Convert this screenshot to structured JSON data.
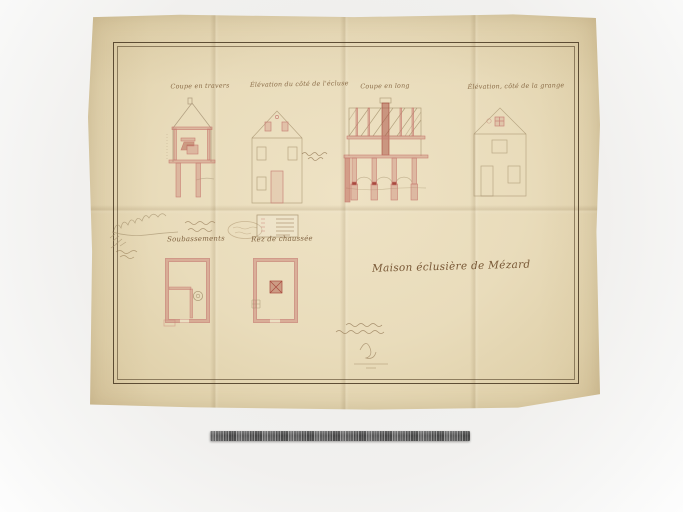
{
  "photo": {
    "subject": "Archival architectural drawing photographed on neutral grey background with photographic scale ruler",
    "media": "ink, pink wash and pencil on aged folded paper"
  },
  "document": {
    "main_title": "Maison éclusière de Mézard",
    "drawing_titles": [
      "Coupe en travers",
      "Élévation du côté de l'écluse",
      "Coupe en long",
      "Élévation, côté de la grange"
    ],
    "plan_titles": [
      "Soubassements",
      "Rez de chaussée"
    ]
  },
  "colors": {
    "background": "#f0efed",
    "paper": "#e8dbba",
    "frame_line": "#57452c",
    "ink_pink": "#c97f73",
    "ink_red": "#a84b3f",
    "pencil": "#b3a183",
    "handwriting": "#6d4a28",
    "ruler": "#545454"
  }
}
